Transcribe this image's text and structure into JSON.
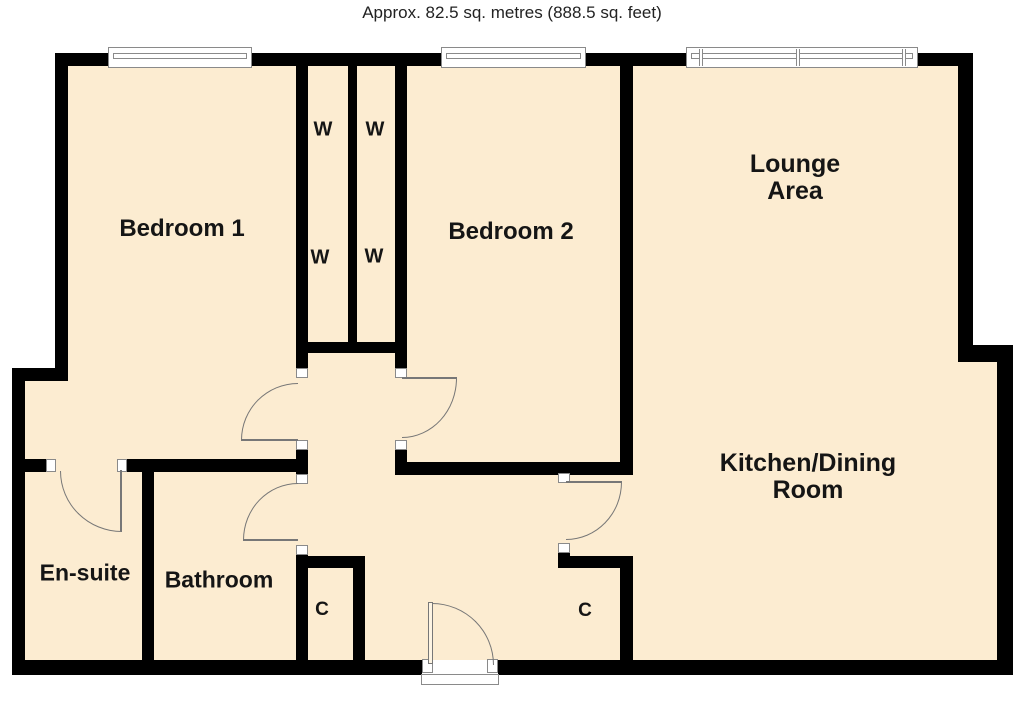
{
  "title": "Approx. 82.5 sq. metres (888.5 sq. feet)",
  "rooms": {
    "bedroom1": "Bedroom 1",
    "bedroom2": "Bedroom 2",
    "lounge_line1": "Lounge",
    "lounge_line2": "Area",
    "kitchen_line1": "Kitchen/Dining",
    "kitchen_line2": "Room",
    "ensuite": "En-suite",
    "bathroom": "Bathroom"
  },
  "closets": {
    "wardrobe": "W",
    "cupboard": "C"
  },
  "colors": {
    "floor": "#FCECD1",
    "wall": "#000000",
    "door_line": "#777777"
  }
}
